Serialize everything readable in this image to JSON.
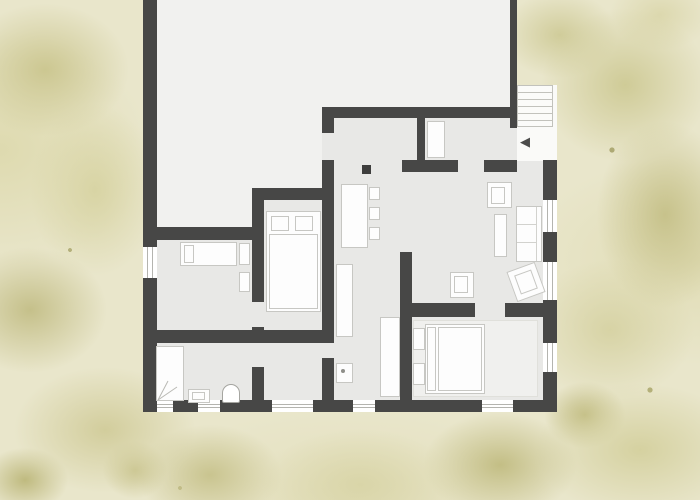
{
  "document": {
    "type": "architectural-floor-plan",
    "view": "top-down",
    "setting": "building surrounded by watercolor garden texture"
  },
  "entrance": {
    "arrow_glyph": "◀",
    "location": "top-right exterior stair landing"
  },
  "stairs": {
    "tread_count": 6,
    "position": "top-right-exterior"
  },
  "colors": {
    "wall": "#474746",
    "room_floor": "#e8e8e6",
    "big_room_floor": "#f1f1ef",
    "background_base": "#e9e6cb",
    "background_foliage": "#ccc791",
    "furniture_fill": "#fdfdfd",
    "furniture_outline": "#c7c7c3"
  },
  "rooms": [
    {
      "id": "big-room-top-left",
      "furniture": []
    },
    {
      "id": "entry-hall",
      "furniture": [
        "closet"
      ]
    },
    {
      "id": "living-dining",
      "furniture": [
        "dining-table",
        "chair",
        "chair",
        "chair",
        "armchair",
        "coffee-table",
        "sofa",
        "rotated-armchair",
        "armchair",
        "column"
      ]
    },
    {
      "id": "kitchen-hallway",
      "furniture": [
        "tall-cabinet",
        "counter",
        "sink-unit"
      ]
    },
    {
      "id": "bedroom-middle",
      "furniture": [
        "double-bed",
        "pillow",
        "pillow"
      ]
    },
    {
      "id": "bedroom-small",
      "furniture": [
        "single-bed",
        "side-table",
        "side-table"
      ]
    },
    {
      "id": "bathroom",
      "furniture": [
        "shower",
        "sink",
        "toilet"
      ]
    },
    {
      "id": "bedroom-master",
      "furniture": [
        "double-bed",
        "nightstand",
        "nightstand",
        "rug"
      ]
    },
    {
      "id": "storage-room",
      "furniture": []
    }
  ],
  "window_openings": 9,
  "door_openings": 8
}
